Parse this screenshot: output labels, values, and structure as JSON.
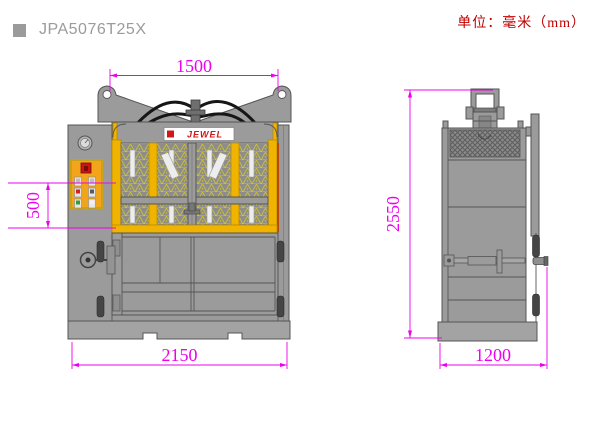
{
  "header": {
    "title": "JPA5076T25X",
    "units": "单位：毫米（mm）"
  },
  "brand": {
    "logo_text": "JEWEL"
  },
  "dimensions": {
    "front": {
      "top_width": "1500",
      "feed_opening_height": "500",
      "base_width": "2150"
    },
    "side": {
      "overall_height": "2550",
      "depth": "1200"
    }
  },
  "colors": {
    "dimension_magenta": "#ee00ee",
    "units_red": "#c00000",
    "title_gray": "#9b9b9b",
    "machine_gray": "#9b9b9b",
    "accent_yellow": "#f0b400",
    "mesh_yellow": "#d2c32c",
    "panel_orange": "#f2a41a",
    "logo_red": "#d01818",
    "emergency_red": "#cc1414",
    "button_green": "#2e9e3e",
    "hose_black": "#161616"
  }
}
